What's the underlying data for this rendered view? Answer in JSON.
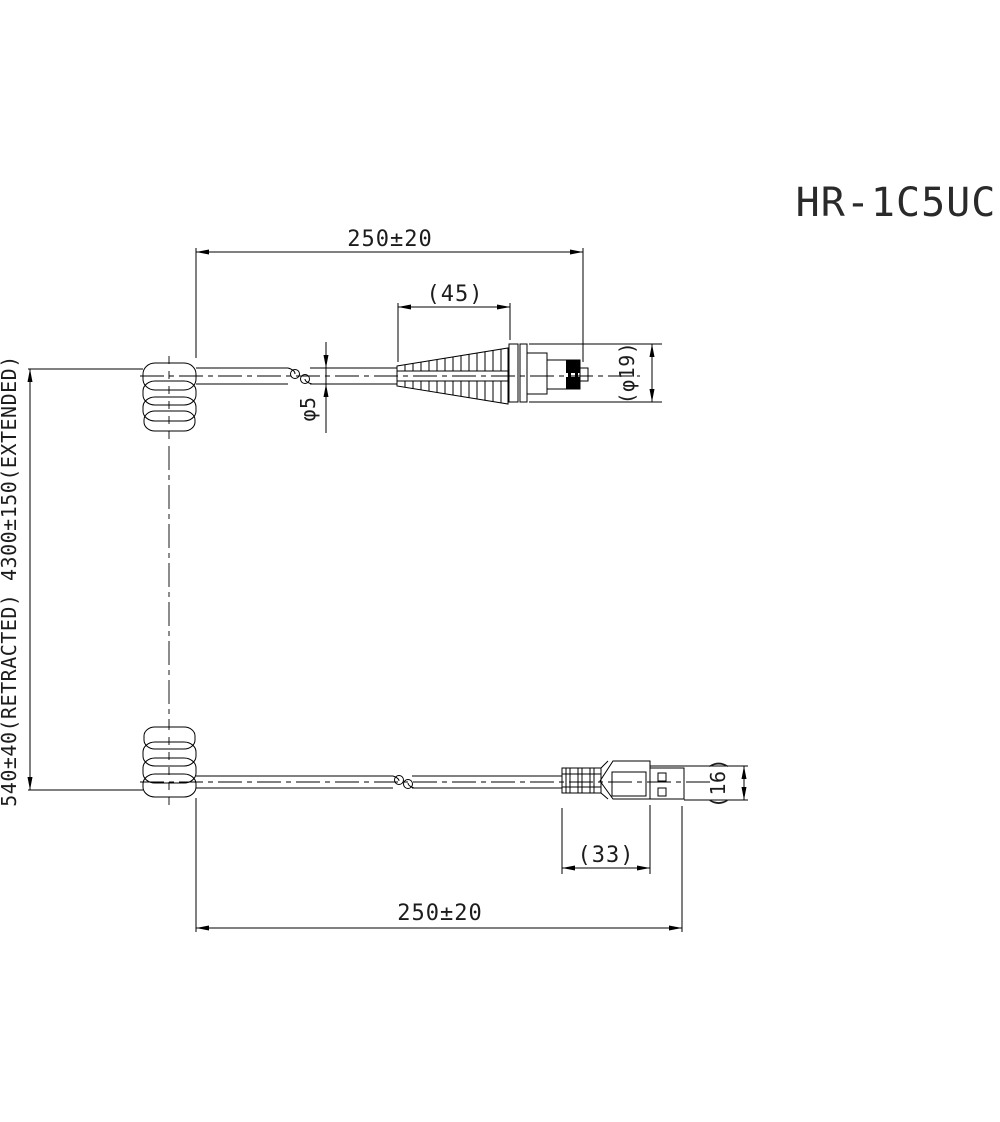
{
  "title": "HR-1C5UC",
  "dimensions": {
    "top_cable_length": "250±20",
    "boot_length": "(45)",
    "cable_diameter": "φ5",
    "connector_diameter": "(φ19)",
    "coil_length": "540±40(RETRACTED) 4300±150(EXTENDED)",
    "usb_plug_length": "(33)",
    "usb_plug_width": "(16)",
    "bottom_cable_length": "250±20"
  },
  "colors": {
    "line": "#000000",
    "text": "#1c1c1c",
    "background": "#ffffff"
  }
}
